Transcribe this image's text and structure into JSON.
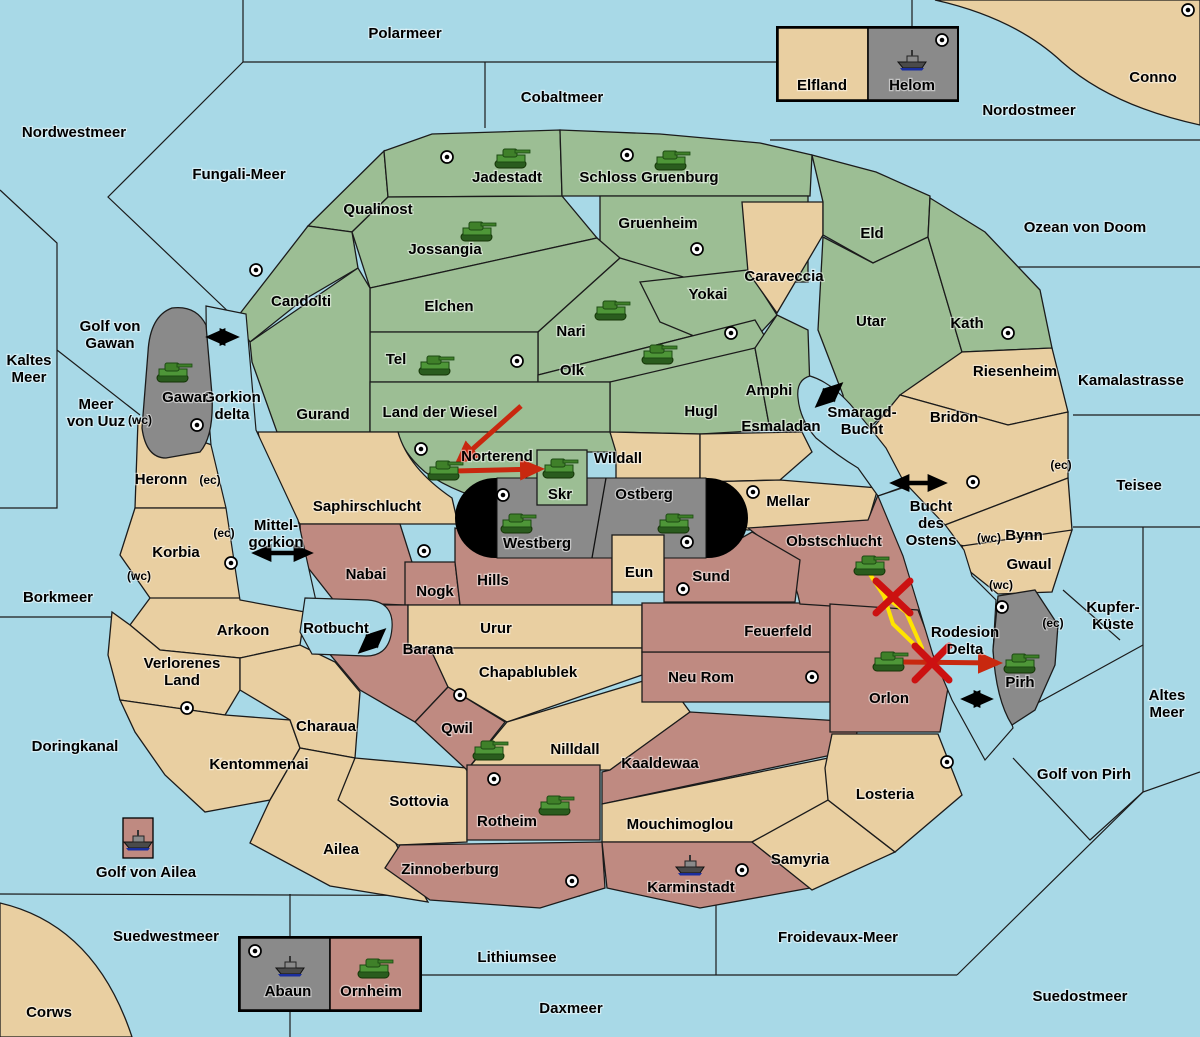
{
  "colors": {
    "sea": "#A8D9E7",
    "green": "#9CBE94",
    "tan": "#E9CFA1",
    "rust": "#BF8A81",
    "gray": "#8A8A8A",
    "capsule_black": "#000000",
    "arrow_black": "#000000",
    "arrow_red": "#C8280F",
    "x_red": "#CC1111",
    "path_yellow": "#FFE400"
  },
  "seas": {
    "polarmeer": "Polarmeer",
    "cobaltmeer": "Cobaltmeer",
    "nordostmeer": "Nordostmeer",
    "nordwestmeer": "Nordwestmeer",
    "fungali_meer": "Fungali-Meer",
    "ozean_von_doom": "Ozean von Doom",
    "kaltes_meer": "Kaltes\nMeer",
    "golf_von_gawan": "Golf von\nGawan",
    "meer_von_uuz": "Meer\nvon Uuz",
    "gorkion_delta": "Gorkion\ndelta",
    "kamalastrasse": "Kamalastrasse",
    "smaragd_bucht": "Smaragd-\nBucht",
    "borkmeer": "Borkmeer",
    "mittel_gorkion": "Mittel-\ngorkion",
    "bucht_des_ostens": "Bucht\ndes\nOstens",
    "teisee": "Teisee",
    "kupfer_kueste": "Kupfer-\nKüste",
    "rotbucht": "Rotbucht",
    "rodesion_delta": "Rodesion\nDelta",
    "altes_meer": "Altes\nMeer",
    "golf_von_pirh": "Golf von Pirh",
    "doringkanal": "Doringkanal",
    "golf_von_ailea": "Golf von Ailea",
    "suedwestmeer": "Suedwestmeer",
    "lithiumsee": "Lithiumsee",
    "daxmeer": "Daxmeer",
    "froidevaux_meer": "Froidevaux-Meer",
    "suedostmeer": "Suedostmeer"
  },
  "territories": {
    "jadestadt": "Jadestadt",
    "schloss_gruenburg": "Schloss Gruenburg",
    "qualinost": "Qualinost",
    "jossangia": "Jossangia",
    "gruenheim": "Gruenheim",
    "candolti": "Candolti",
    "caraveccia": "Caraveccia",
    "eld": "Eld",
    "elchen": "Elchen",
    "nari": "Nari",
    "yokai": "Yokai",
    "tel": "Tel",
    "olk": "Olk",
    "utar": "Utar",
    "kath": "Kath",
    "riesenheim": "Riesenheim",
    "bridon": "Bridon",
    "bynn": "Bynn",
    "gwaul": "Gwaul",
    "amphi": "Amphi",
    "hugl": "Hugl",
    "gurand": "Gurand",
    "land_der_wiesel": "Land der Wiesel",
    "norterend": "Norterend",
    "skr": "Skr",
    "wildall": "Wildall",
    "esmaladan": "Esmaladan",
    "mellar": "Mellar",
    "saphirschlucht": "Saphirschlucht",
    "westberg": "Westberg",
    "ostberg": "Ostberg",
    "eun": "Eun",
    "sund": "Sund",
    "obstschlucht": "Obstschlucht",
    "gawar": "Gawar",
    "heronn": "Heronn",
    "korbia": "Korbia",
    "arkoon": "Arkoon",
    "verlorenes_land": "Verlorenes\nLand",
    "charaua": "Charaua",
    "kentommenai": "Kentommenai",
    "sottovia": "Sottovia",
    "ailea": "Ailea",
    "nabai": "Nabai",
    "nogk": "Nogk",
    "hills": "Hills",
    "barana": "Barana",
    "urur": "Urur",
    "chapablublek": "Chapablublek",
    "qwil": "Qwil",
    "nilldall": "Nilldall",
    "kaaldewaa": "Kaaldewaa",
    "neu_rom": "Neu Rom",
    "feuerfeld": "Feuerfeld",
    "orlon": "Orlon",
    "rotheim": "Rotheim",
    "zinnoberburg": "Zinnoberburg",
    "mouchimoglou": "Mouchimoglou",
    "karminstadt": "Karminstadt",
    "samyria": "Samyria",
    "losteria": "Losteria",
    "pirh": "Pirh",
    "elfland": "Elfland",
    "helom": "Helom",
    "abaun": "Abaun",
    "ornheim": "Ornheim",
    "conno": "Conno",
    "corws": "Corws"
  },
  "coast_markers": {
    "wc": "(wc)",
    "ec": "(ec)"
  },
  "icons": {
    "tank": "green-tank-unit",
    "warship": "gray-warship-unit",
    "city": "city-dot-marker"
  }
}
